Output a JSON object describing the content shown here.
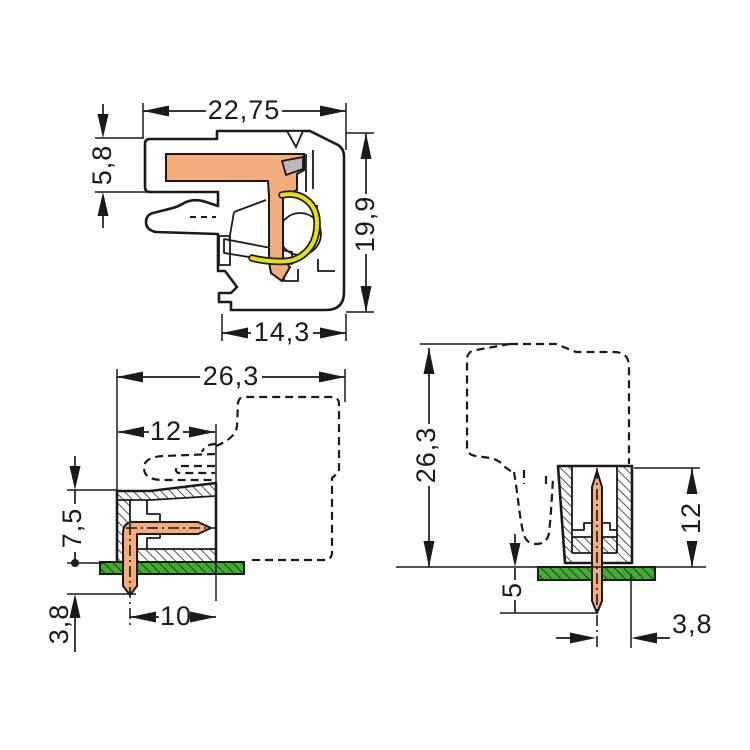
{
  "drawing": {
    "title": "Connector dimensional drawing, three views",
    "unit": "mm",
    "colors": {
      "background": "#ffffff",
      "outline": "#1a1a1a",
      "housing_gray": "#b9b9b9",
      "contact_orange": "#f5ac7d",
      "spring_yellow": "#e6e300",
      "pcb_green": "#3fae2c"
    },
    "views": {
      "side_section": {
        "label": "Female connector side cross-section",
        "dims": {
          "width_top": "22,75",
          "height_left": "5,8",
          "height_right": "19,9",
          "width_bottom": "14,3"
        }
      },
      "angled_header": {
        "label": "Angled PCB header with mating connector outline",
        "dims": {
          "width_total": "26,3",
          "width_housing": "12",
          "height_above_board": "7,5",
          "pin_below_board": "3,8",
          "pin_offset": "10"
        }
      },
      "straight_header": {
        "label": "Straight PCB header with mating connector outline",
        "dims": {
          "height_total": "26,3",
          "height_housing": "12",
          "pin_below_board": "5",
          "pin_edge_offset": "3,8"
        }
      }
    }
  }
}
